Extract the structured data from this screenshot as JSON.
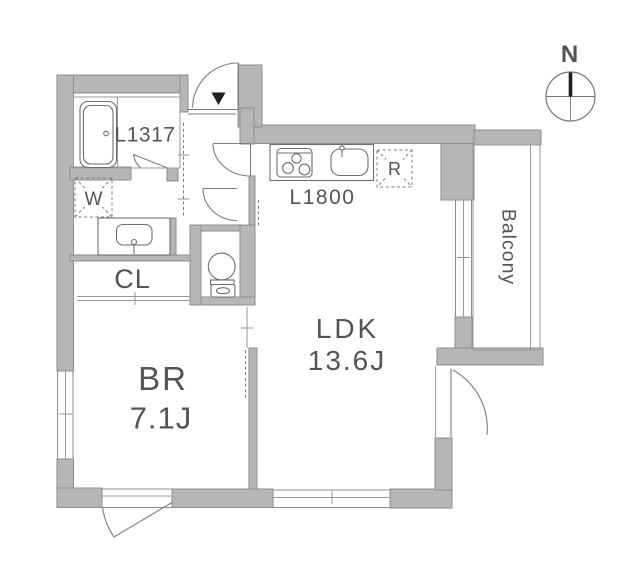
{
  "title": "apartment-floor-plan",
  "labels": {
    "bath_unit": "L1317",
    "kitchen_unit": "L1800",
    "washer": "W",
    "fridge": "R",
    "closet": "CL",
    "bedroom": "BR",
    "bedroom_size": "7.1J",
    "ldk": "LDK",
    "ldk_size": "13.6J",
    "balcony": "Balcony",
    "north": "N"
  },
  "colors": {
    "bg": "#ffffff",
    "wall": "#b6b6b6",
    "wall-stroke": "#8d8d8d",
    "line": "#7d7d7d",
    "fixture": "#6e6e6e",
    "text": "#545454",
    "dark": "#1f1f1f"
  }
}
